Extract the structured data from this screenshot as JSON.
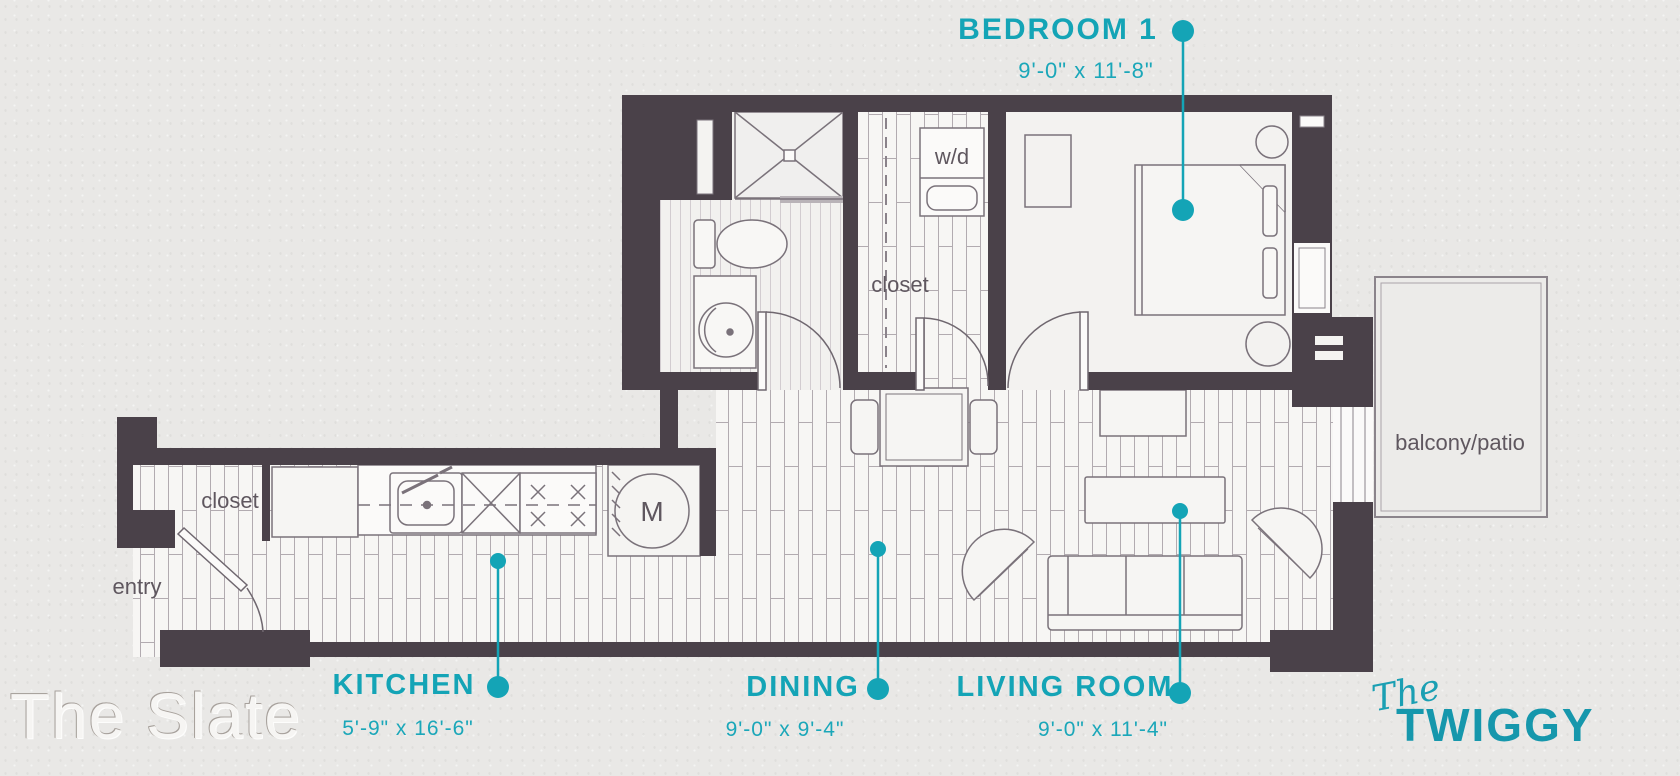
{
  "watermark": "The Slate",
  "logo": {
    "prefix": "The",
    "name": "TWIGGY"
  },
  "colors": {
    "accent_teal": "#14a4b6",
    "wall": "#4a4149",
    "background": "#e9e8e6",
    "plan_label": "#5f575f"
  },
  "rooms": {
    "bedroom": {
      "label": "BEDROOM 1",
      "dims": "9'-0\" x 11'-8\""
    },
    "kitchen": {
      "label": "KITCHEN",
      "dims": "5'-9\" x 16'-6\""
    },
    "dining": {
      "label": "DINING",
      "dims": "9'-0\" x 9'-4\""
    },
    "living": {
      "label": "LIVING ROOM",
      "dims": "9'-0\" x 11'-4\""
    }
  },
  "plan_labels": {
    "washer_dryer": "w/d",
    "hall_closet": "closet",
    "entry_closet": "closet",
    "entry": "entry",
    "balcony": "balcony/patio",
    "mechanical": "M"
  }
}
